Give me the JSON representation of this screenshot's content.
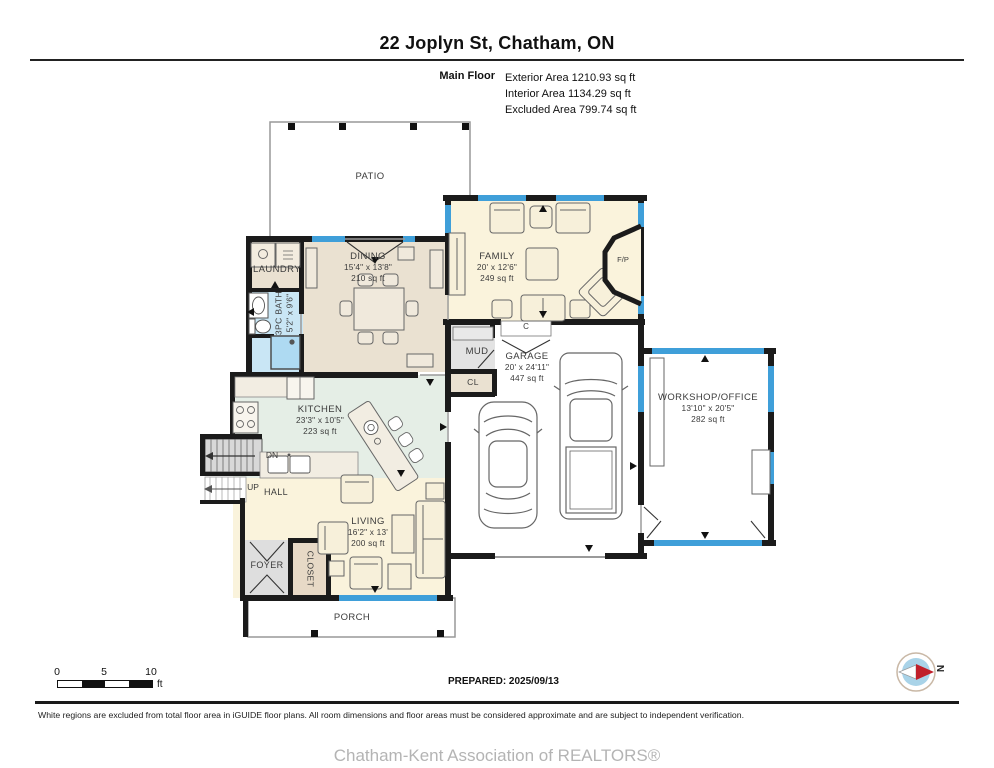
{
  "header": {
    "title": "22 Joplyn St, Chatham, ON",
    "floor_label": "Main Floor",
    "stats": [
      "Exterior Area 1210.93 sq ft",
      "Interior Area 1134.29 sq ft",
      "Excluded Area 799.74 sq ft"
    ]
  },
  "rooms": {
    "patio": {
      "name": "PATIO"
    },
    "laundry": {
      "name": "LAUNDRY"
    },
    "bath": {
      "name": "3PC BATH",
      "dims": "5'2\" x 9'6\""
    },
    "dining": {
      "name": "DINING",
      "dims": "15'4\" x 13'8\"",
      "area": "210 sq ft"
    },
    "family": {
      "name": "FAMILY",
      "dims": "20' x 12'6\"",
      "area": "249 sq ft"
    },
    "mud": {
      "name": "MUD"
    },
    "cl": {
      "name": "CL"
    },
    "c": {
      "name": "C"
    },
    "fp": {
      "name": "F/P"
    },
    "garage": {
      "name": "GARAGE",
      "dims": "20' x 24'11\"",
      "area": "447 sq ft"
    },
    "workshop": {
      "name": "WORKSHOP/OFFICE",
      "dims": "13'10\" x 20'5\"",
      "area": "282 sq ft"
    },
    "kitchen": {
      "name": "KITCHEN",
      "dims": "23'3\" x 10'5\"",
      "area": "223 sq ft"
    },
    "hall": {
      "name": "HALL"
    },
    "living": {
      "name": "LIVING",
      "dims": "16'2\" x 13'",
      "area": "200 sq ft"
    },
    "foyer": {
      "name": "FOYER"
    },
    "closet": {
      "name": "CLOSET"
    },
    "porch": {
      "name": "PORCH"
    },
    "stairs_dn": {
      "name": "DN"
    },
    "stairs_up": {
      "name": "UP"
    }
  },
  "scale_bar": {
    "tick_0": "0",
    "tick_5": "5",
    "tick_10": "10",
    "unit": "ft"
  },
  "compass": {
    "north_label": "N"
  },
  "footer": {
    "prepared": "PREPARED: 2025/09/13",
    "disclaimer": "White regions are excluded from total floor area in iGUIDE floor plans. All room dimensions and floor areas must be considered approximate and are subject to independent verification.",
    "association": "Chatham-Kent Association of REALTORS®"
  },
  "colors": {
    "wall": "#1b1b1b",
    "window": "#3f9fd9",
    "floor_warm": "#faf3dc",
    "floor_tan": "#eae1d1",
    "floor_green": "#e5eee6",
    "floor_blue": "#c9e6f5",
    "floor_gray": "#e0e0e0",
    "excluded": "#ffffff"
  }
}
